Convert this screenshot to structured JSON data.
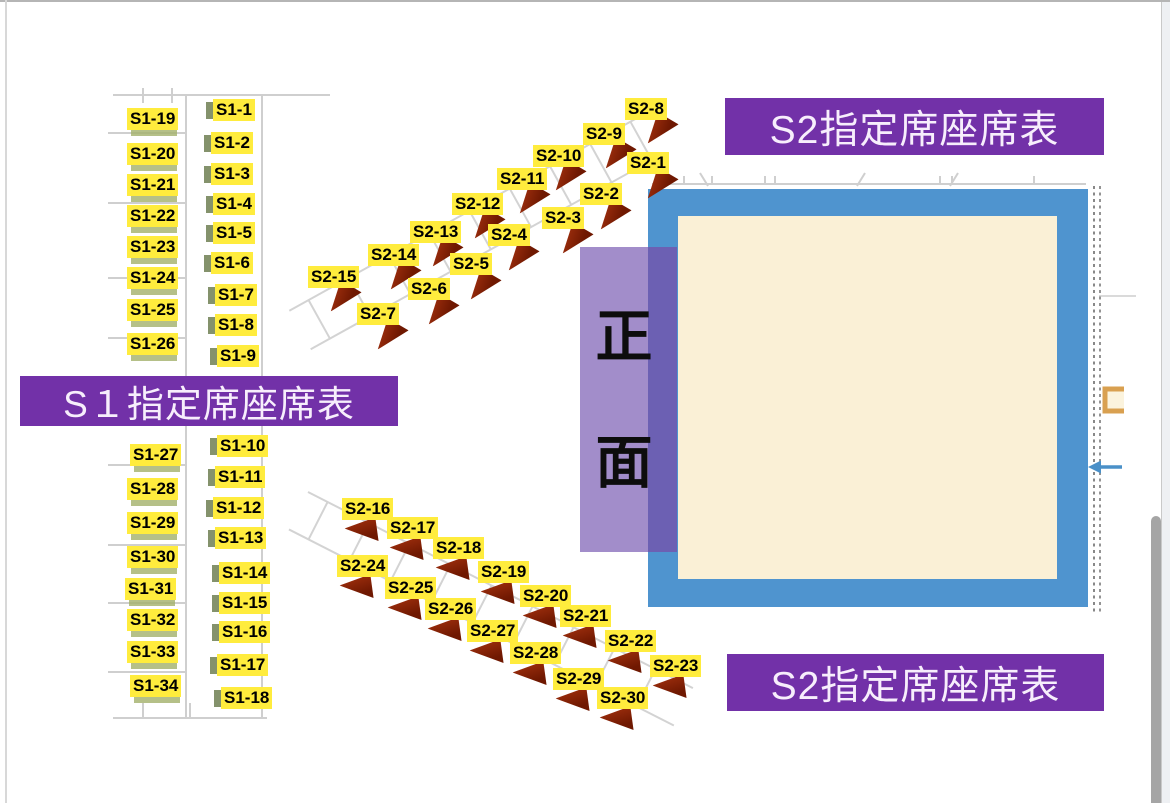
{
  "banners": {
    "s1": "S１指定席座席表",
    "s2_top": "S2指定席座席表",
    "s2_bottom": "S2指定席座席表"
  },
  "stage": {
    "front_chars": [
      "正",
      "面"
    ]
  },
  "colors": {
    "banner_purple": "#7231a8",
    "label_yellow": "#ffec3d",
    "stage_blue": "#4f94cf",
    "stage_cream": "#faf0d6",
    "front_purple": "#a28dca",
    "front_purple_overlap": "#6c60b3",
    "seat_triangle_red": "#8a2506",
    "plan_line_gray": "#cfcfcf"
  },
  "seat_groups": [
    {
      "id": "s1-column-a-upper",
      "mark": "bar",
      "items": [
        {
          "label": "S1-19",
          "x": 127,
          "y": 108
        },
        {
          "label": "S1-20",
          "x": 127,
          "y": 143
        },
        {
          "label": "S1-21",
          "x": 127,
          "y": 174
        },
        {
          "label": "S1-22",
          "x": 127,
          "y": 205
        },
        {
          "label": "S1-23",
          "x": 127,
          "y": 236
        },
        {
          "label": "S1-24",
          "x": 127,
          "y": 267
        },
        {
          "label": "S1-25",
          "x": 127,
          "y": 299
        },
        {
          "label": "S1-26",
          "x": 127,
          "y": 333
        }
      ]
    },
    {
      "id": "s1-column-b-upper",
      "mark": "tab",
      "items": [
        {
          "label": "S1-1",
          "x": 213,
          "y": 99
        },
        {
          "label": "S1-2",
          "x": 211,
          "y": 132
        },
        {
          "label": "S1-3",
          "x": 211,
          "y": 163
        },
        {
          "label": "S1-4",
          "x": 213,
          "y": 193
        },
        {
          "label": "S1-5",
          "x": 213,
          "y": 222
        },
        {
          "label": "S1-6",
          "x": 211,
          "y": 252
        },
        {
          "label": "S1-7",
          "x": 215,
          "y": 284
        },
        {
          "label": "S1-8",
          "x": 215,
          "y": 314
        },
        {
          "label": "S1-9",
          "x": 217,
          "y": 345
        }
      ]
    },
    {
      "id": "s1-column-a-lower",
      "mark": "bar",
      "items": [
        {
          "label": "S1-27",
          "x": 130,
          "y": 444
        },
        {
          "label": "S1-28",
          "x": 127,
          "y": 478
        },
        {
          "label": "S1-29",
          "x": 127,
          "y": 512
        },
        {
          "label": "S1-30",
          "x": 127,
          "y": 546
        },
        {
          "label": "S1-31",
          "x": 125,
          "y": 578
        },
        {
          "label": "S1-32",
          "x": 127,
          "y": 609
        },
        {
          "label": "S1-33",
          "x": 127,
          "y": 641
        },
        {
          "label": "S1-34",
          "x": 130,
          "y": 675
        }
      ]
    },
    {
      "id": "s1-column-b-lower",
      "mark": "tab",
      "items": [
        {
          "label": "S1-10",
          "x": 217,
          "y": 435
        },
        {
          "label": "S1-11",
          "x": 215,
          "y": 466
        },
        {
          "label": "S1-12",
          "x": 213,
          "y": 497
        },
        {
          "label": "S1-13",
          "x": 215,
          "y": 527
        },
        {
          "label": "S1-14",
          "x": 219,
          "y": 562
        },
        {
          "label": "S1-15",
          "x": 219,
          "y": 592
        },
        {
          "label": "S1-16",
          "x": 219,
          "y": 621
        },
        {
          "label": "S1-17",
          "x": 217,
          "y": 654
        },
        {
          "label": "S1-18",
          "x": 221,
          "y": 687
        }
      ]
    },
    {
      "id": "s2-upper-back-row",
      "triangle": true,
      "rot": -25,
      "tdx": 16,
      "tdy": 15,
      "items": [
        {
          "label": "S2-8",
          "x": 625,
          "y": 98
        },
        {
          "label": "S2-9",
          "x": 583,
          "y": 123
        },
        {
          "label": "S2-10",
          "x": 533,
          "y": 145
        },
        {
          "label": "S2-11",
          "x": 497,
          "y": 168
        },
        {
          "label": "S2-12",
          "x": 452,
          "y": 193
        },
        {
          "label": "S2-13",
          "x": 410,
          "y": 221
        },
        {
          "label": "S2-14",
          "x": 368,
          "y": 244
        },
        {
          "label": "S2-15",
          "x": 308,
          "y": 266
        }
      ]
    },
    {
      "id": "s2-upper-front-row",
      "triangle": true,
      "rot": -25,
      "tdx": 14,
      "tdy": 16,
      "items": [
        {
          "label": "S2-1",
          "x": 627,
          "y": 152
        },
        {
          "label": "S2-2",
          "x": 580,
          "y": 183
        },
        {
          "label": "S2-3",
          "x": 542,
          "y": 207
        },
        {
          "label": "S2-4",
          "x": 488,
          "y": 224
        },
        {
          "label": "S2-5",
          "x": 450,
          "y": 253
        },
        {
          "label": "S2-6",
          "x": 408,
          "y": 278
        },
        {
          "label": "S2-7",
          "x": 357,
          "y": 303
        }
      ]
    },
    {
      "id": "s2-lower-back-row",
      "triangle": true,
      "rot": 27,
      "tdx": 6,
      "tdy": 16,
      "items": [
        {
          "label": "S2-16",
          "x": 342,
          "y": 498
        },
        {
          "label": "S2-17",
          "x": 387,
          "y": 517
        },
        {
          "label": "S2-18",
          "x": 433,
          "y": 537
        },
        {
          "label": "S2-19",
          "x": 478,
          "y": 561
        },
        {
          "label": "S2-20",
          "x": 520,
          "y": 585
        },
        {
          "label": "S2-21",
          "x": 560,
          "y": 605
        },
        {
          "label": "S2-22",
          "x": 605,
          "y": 630
        },
        {
          "label": "S2-23",
          "x": 650,
          "y": 655
        }
      ]
    },
    {
      "id": "s2-lower-front-row",
      "triangle": true,
      "rot": 27,
      "tdx": 6,
      "tdy": 16,
      "items": [
        {
          "label": "S2-24",
          "x": 337,
          "y": 555
        },
        {
          "label": "S2-25",
          "x": 385,
          "y": 577
        },
        {
          "label": "S2-26",
          "x": 425,
          "y": 598
        },
        {
          "label": "S2-27",
          "x": 467,
          "y": 620
        },
        {
          "label": "S2-28",
          "x": 510,
          "y": 642
        },
        {
          "label": "S2-29",
          "x": 553,
          "y": 668
        },
        {
          "label": "S2-30",
          "x": 597,
          "y": 687
        }
      ]
    }
  ]
}
